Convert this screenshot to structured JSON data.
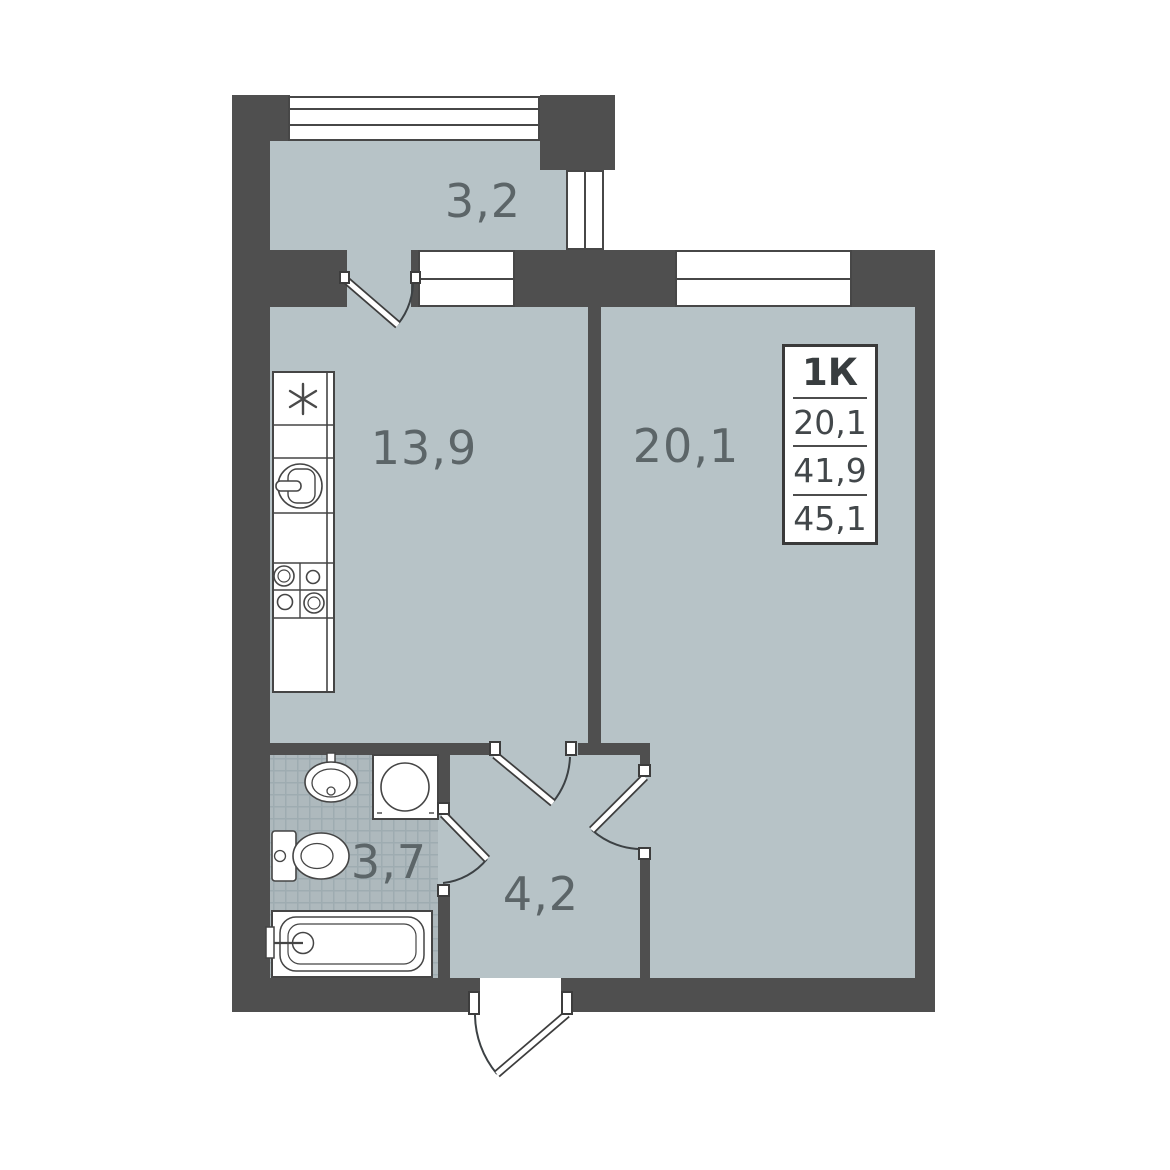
{
  "plan": {
    "title": "1-room apartment floor plan",
    "info_box": {
      "type_label": "1К",
      "values": [
        "20,1",
        "41,9",
        "45,1"
      ]
    },
    "room_areas": {
      "balcony": "3,2",
      "kitchen": "13,9",
      "living_room": "20,1",
      "bathroom": "3,7",
      "hallway": "4,2"
    },
    "colors": {
      "wall": "#4f4f4f",
      "floor": "#b7c3c7",
      "bathroom_tile": "#aeb9bd",
      "outline": "#454545",
      "label_text": "#5c6568",
      "background": "#ffffff"
    }
  }
}
